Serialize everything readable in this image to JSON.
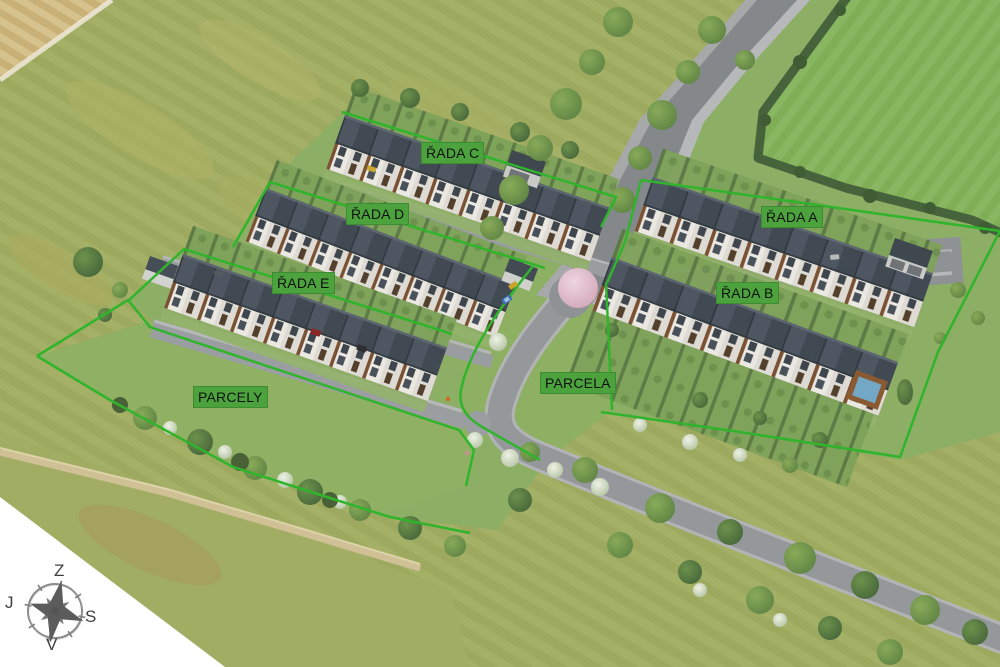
{
  "area_labels": [
    {
      "id": "rada-c",
      "text": "ŘADA C"
    },
    {
      "id": "rada-d",
      "text": "ŘADA D"
    },
    {
      "id": "rada-e",
      "text": "ŘADA E"
    },
    {
      "id": "rada-a",
      "text": "ŘADA A"
    },
    {
      "id": "rada-b",
      "text": "ŘADA B"
    },
    {
      "id": "parcely",
      "text": "PARCELY"
    },
    {
      "id": "parcela",
      "text": "PARCELA"
    }
  ],
  "compass": {
    "top": "Z",
    "right": "S",
    "bottom": "V",
    "left": "J"
  },
  "colors": {
    "label_bg": "#4ca33e",
    "label_text": "#111111",
    "boundary_green": "#2fb42c",
    "compass_text": "#3f3f3f"
  }
}
